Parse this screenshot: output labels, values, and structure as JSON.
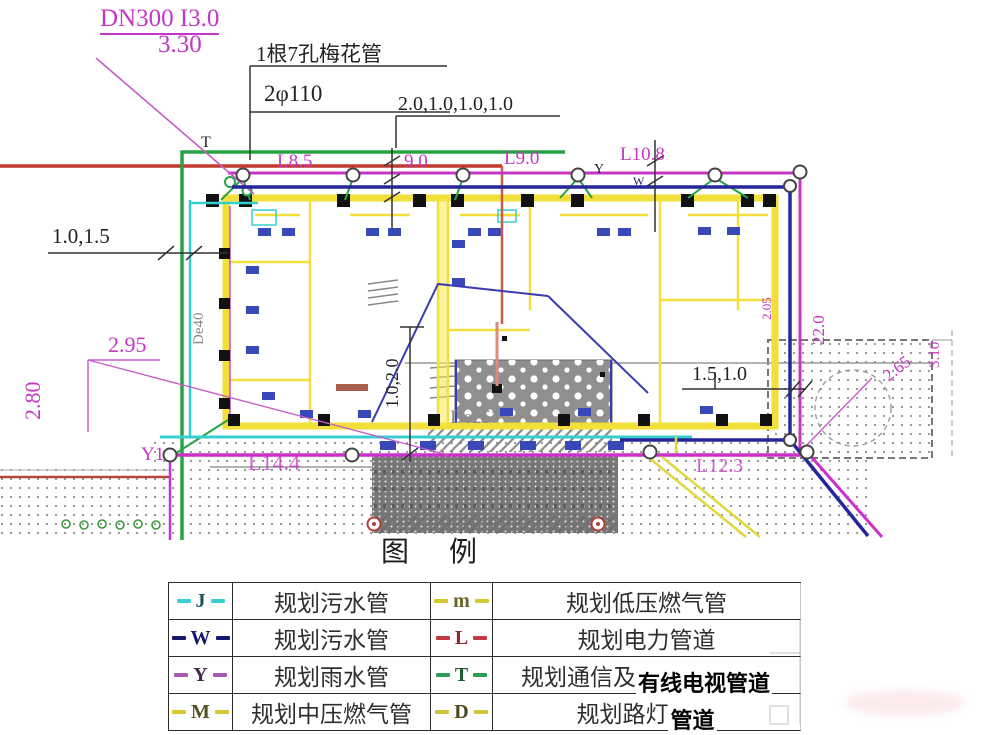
{
  "annotations": {
    "dn300_label": "DN300 I3.0",
    "dn300_elev": "3.30",
    "plum_line1": "1根7孔梅花管",
    "plum_line2": "2φ110",
    "dims_top": "2.0,1.0,1.0,1.0",
    "dims_left": "1.0,1.5",
    "len_l85": "L8.5",
    "len_90": "9.0",
    "len_l90": "L9.0",
    "len_l108": "L10.8",
    "mark_t": "T",
    "mark_y": "Y",
    "mark_w": "W",
    "de40": "De40",
    "elev_295": "2.95",
    "elev_280": "2.80",
    "y1": "Y1",
    "len_l144": "L14.4",
    "len_l123": "L12.3",
    "de257": "De257",
    "dims_mid": "1.0,2.0",
    "dims_right": "1.5,1.0",
    "elev_205": "2.05",
    "len_220": "22.0",
    "elev_265": "2.65",
    "elev_310": "3.10"
  },
  "colors": {
    "magenta": "#c536c5",
    "red": "#c23a2e",
    "green": "#27a344",
    "cyan": "#35cfcf",
    "blue": "#26269c",
    "yellow": "#f2df3a"
  },
  "legend": {
    "title": "图　例",
    "left_rows": [
      {
        "code": "J",
        "label": "规划污水管",
        "color": "#3ecdd1",
        "code_color": "#1d4f5e"
      },
      {
        "code": "W",
        "label": "规划污水管",
        "color": "#16166e",
        "code_color": "#16166e"
      },
      {
        "code": "Y",
        "label": "规划雨水管",
        "color": "#a85ab2",
        "code_color": "#46264e"
      },
      {
        "code": "M",
        "label": "规划中压燃气管",
        "color": "#d6c832",
        "code_color": "#56501e"
      }
    ],
    "right_rows": [
      {
        "code": "m",
        "label": "规划低压燃气管",
        "bold_label": "",
        "color": "#d6c832",
        "code_color": "#6a6426"
      },
      {
        "code": "L",
        "label": "规划电力管道",
        "bold_label": "",
        "color": "#c23a46",
        "code_color": "#8a2a32"
      },
      {
        "code": "T",
        "label": "规划通信及",
        "bold_label": "有线电视管道",
        "color": "#2f9e54",
        "code_color": "#1e5c34"
      },
      {
        "code": "D",
        "label": "规划路灯",
        "bold_label": "管道",
        "color": "#d0c23a",
        "code_color": "#4a4a1e"
      }
    ]
  }
}
